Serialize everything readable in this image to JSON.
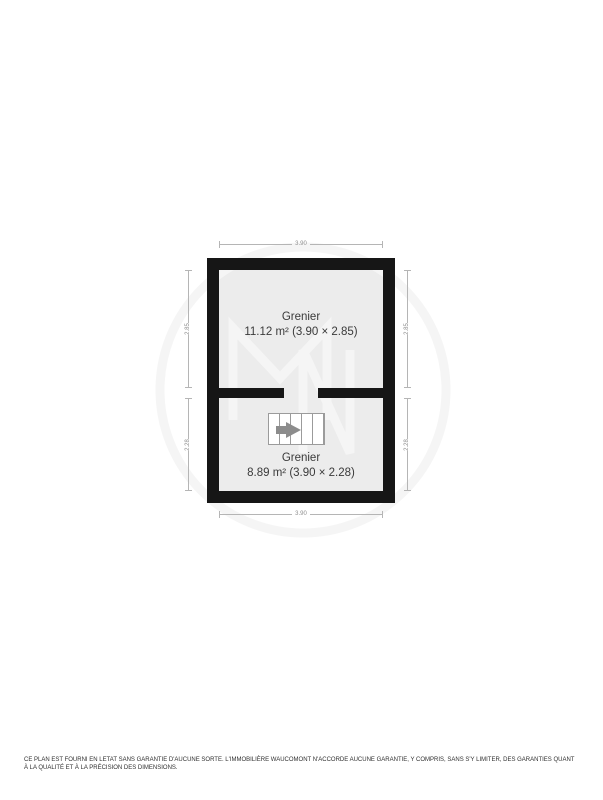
{
  "floorplan": {
    "rooms": [
      {
        "name": "Grenier",
        "details": "11.12 m² (3.90 × 2.85)"
      },
      {
        "name": "Grenier",
        "details": "8.89 m² (3.90 × 2.28)"
      }
    ],
    "dimensions": {
      "top": "3.90",
      "bottom": "3.90",
      "left_upper": "2.85",
      "left_lower": "2.28",
      "right_upper": "2.85",
      "right_lower": "2.28"
    },
    "icons": {
      "stairs": "stairs-icon",
      "direction_arrow": "arrow-right-icon"
    },
    "watermark": {
      "letters": "MN",
      "shape": "circle-monogram"
    },
    "colors": {
      "wall": "#161616",
      "room_fill": "#ececec",
      "dimension_line": "#b5b5b5",
      "dimension_text": "#8f8f8f",
      "label_text": "#3a3a3a",
      "stair_border": "#9b9b9b",
      "arrow": "#8c8c8c",
      "watermark": "#f5f5f5"
    }
  },
  "footer": {
    "disclaimer": "CE PLAN EST FOURNI EN LETAT SANS GARANTIE D'AUCUNE SORTE. L'IMMOBILIÈRE WAUCOMONT N'ACCORDE AUCUNE GARANTIE, Y COMPRIS, SANS S'Y LIMITER, DES GARANTIES QUANT À LA QUALITÉ ET À LA PRÉCISION DES DIMENSIONS."
  }
}
